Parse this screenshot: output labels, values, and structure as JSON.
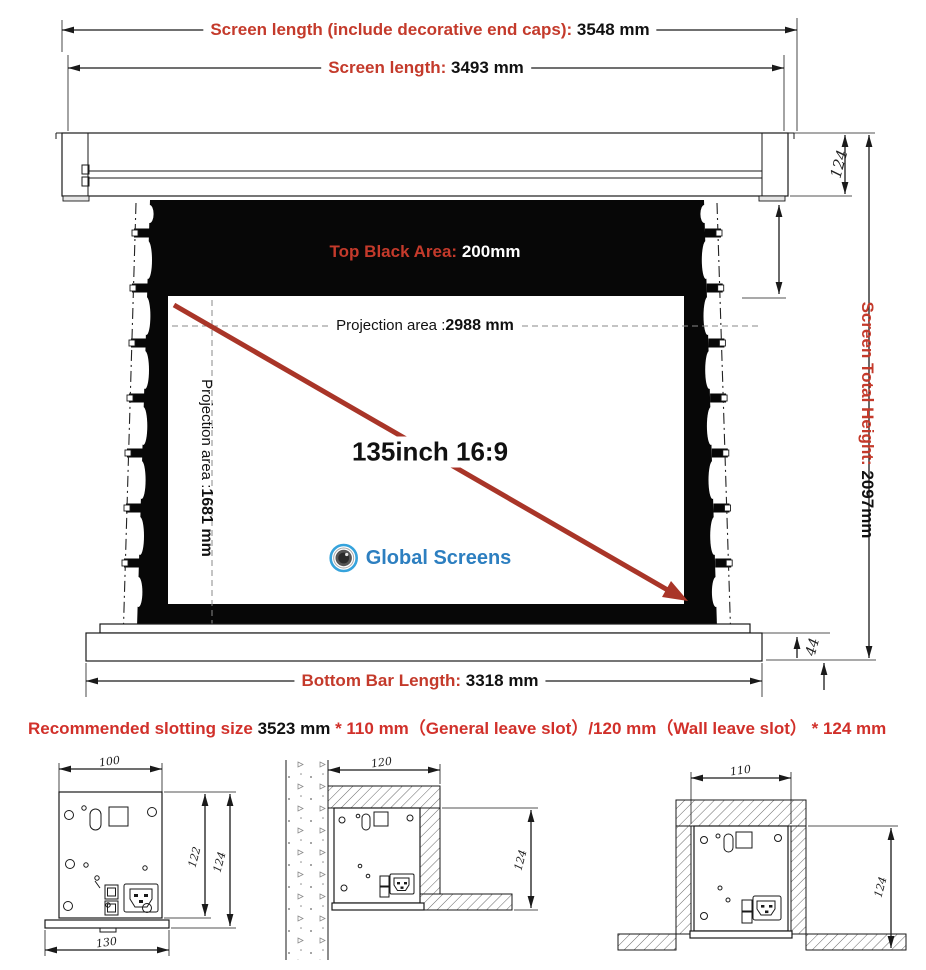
{
  "labels": {
    "full_length": {
      "label": "Screen length (include decorative end caps):",
      "value": "3548 mm"
    },
    "screen_length": {
      "label": "Screen length:",
      "value": "3493 mm"
    },
    "top_black": {
      "label": "Top Black Area:",
      "value": "200mm"
    },
    "proj_width": {
      "label": "Projection area :",
      "value": "2988 mm"
    },
    "proj_height": {
      "label": "Projection area :",
      "value": "1681 mm"
    },
    "diagonal_size": "135inch 16:9",
    "brand": "Global Screens",
    "housing_height": "124",
    "total_height": {
      "label": "Screen Total Height:",
      "value": "2097mm"
    },
    "bottom_bar_height": "44",
    "bottom_bar": {
      "label": "Bottom Bar Length:",
      "value": "3318 mm"
    },
    "slotting": {
      "label": "Recommended slotting size",
      "value": "3523 mm",
      "rest": "* 110 mm（General leave slot）/120 mm（Wall leave slot） * 124 mm"
    }
  },
  "drawings": {
    "end_view": {
      "top_width": "100",
      "body_height": "122",
      "total_height": "124",
      "base_width": "130"
    },
    "wall_slot": {
      "slot_width": "120",
      "slot_height": "124"
    },
    "ceiling_slot": {
      "slot_width": "110",
      "slot_height": "124"
    }
  },
  "colors": {
    "label_red": "#c43a2b",
    "slot_red": "#d1302a",
    "arrow_red": "#a93528",
    "brand_blue": "#2d7fc0",
    "ring_blue": "#36a3dc",
    "fabric_black": "#070707"
  }
}
